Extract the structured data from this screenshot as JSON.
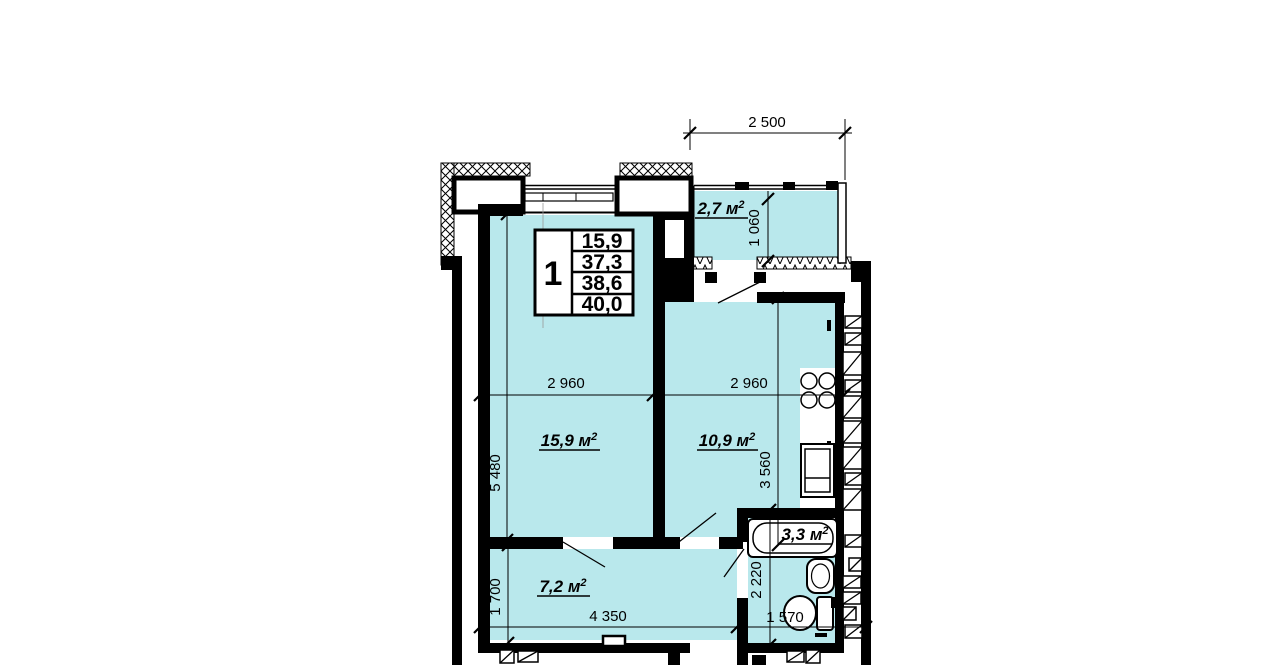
{
  "floor_plan": {
    "info_table": {
      "flat_number": "1",
      "values": [
        "15,9",
        "37,3",
        "38,6",
        "40,0"
      ]
    },
    "rooms": {
      "living": {
        "area": "15,9 м",
        "sup": "2"
      },
      "kitchen": {
        "area": "10,9 м",
        "sup": "2"
      },
      "hall": {
        "area": "7,2 м",
        "sup": "2"
      },
      "bathroom": {
        "area": "3,3 м",
        "sup": "2"
      },
      "balcony": {
        "area": "2,7 м",
        "sup": "2"
      }
    },
    "dimensions": {
      "balcony_width": "2 500",
      "balcony_depth": "1 060",
      "living_width": "2 960",
      "kitchen_width": "2 960",
      "living_depth": "5 480",
      "kitchen_depth": "3 560",
      "hall_depth": "1 700",
      "hall_width": "4 350",
      "bathroom_depth": "2 220",
      "bathroom_width": "1 570"
    },
    "colors": {
      "room_fill": "#b9e8ec",
      "wall": "#000000"
    }
  }
}
